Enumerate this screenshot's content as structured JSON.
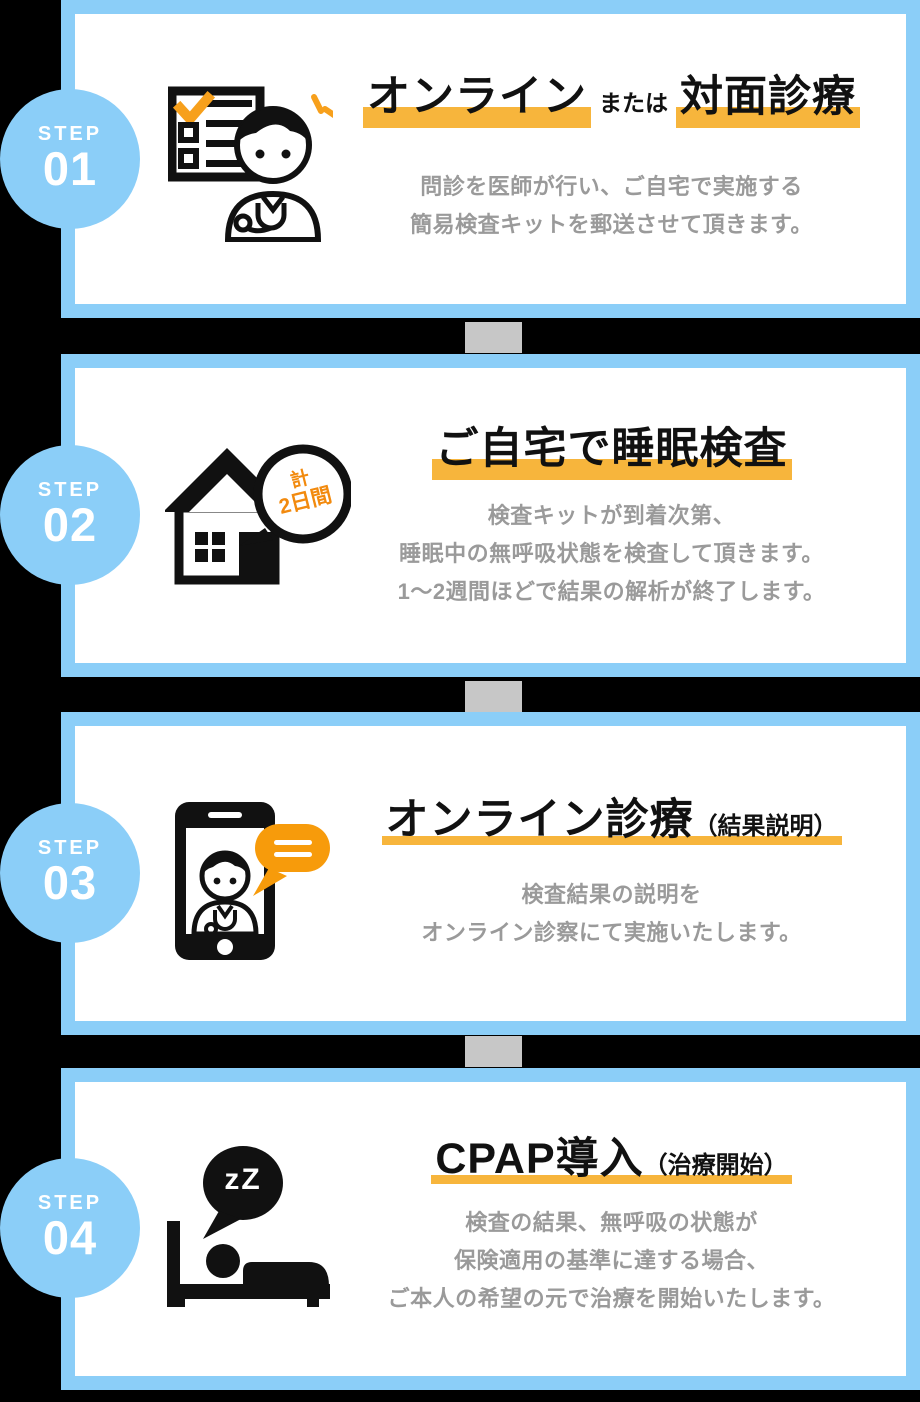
{
  "colors": {
    "background": "#000000",
    "card_border_blue": "#8BCEF8",
    "card_fill": "#FFFFFF",
    "step_circle_blue": "#8BCEF8",
    "step_text": "#FFFFFF",
    "connector_gray": "#C7C7C7",
    "title_text": "#111111",
    "body_text": "#9A9A9A",
    "highlight_orange": "#F7B53C",
    "icon_accent_orange": "#F79B0B",
    "badge_orange": "#F28A0E",
    "icon_black": "#111111"
  },
  "steps": [
    {
      "label": "STEP",
      "number": "01",
      "icon": "checklist-doctor-icon",
      "title_parts": [
        {
          "text": "オンライン",
          "highlight": true,
          "size": "large"
        },
        {
          "text": "または",
          "highlight": false,
          "size": "small"
        },
        {
          "text": "対面診療",
          "highlight": true,
          "size": "large"
        }
      ],
      "body_lines": [
        "問診を医師が行い、ご自宅で実施する",
        "簡易検査キットを郵送させて頂きます。"
      ]
    },
    {
      "label": "STEP",
      "number": "02",
      "icon": "house-sleep-test-icon",
      "badge": {
        "line1": "計",
        "line2": "2日間"
      },
      "title_parts": [
        {
          "text": "ご自宅で睡眠検査",
          "highlight": true,
          "size": "large"
        }
      ],
      "body_lines": [
        "検査キットが到着次第、",
        "睡眠中の無呼吸状態を検査して頂きます。",
        "1〜2週間ほどで結果の解析が終了します。"
      ]
    },
    {
      "label": "STEP",
      "number": "03",
      "icon": "smartphone-doctor-icon",
      "title_parts": [
        {
          "text": "オンライン診療",
          "highlight": true,
          "size": "large"
        },
        {
          "text": "（結果説明）",
          "highlight": true,
          "size": "small"
        }
      ],
      "body_lines": [
        "検査結果の説明を",
        "オンライン診察にて実施いたします。"
      ]
    },
    {
      "label": "STEP",
      "number": "04",
      "icon": "sleep-bed-icon",
      "badge_text": "zZ",
      "title_parts": [
        {
          "text": "CPAP導入",
          "highlight": true,
          "size": "large"
        },
        {
          "text": "（治療開始）",
          "highlight": true,
          "size": "small"
        }
      ],
      "body_lines": [
        "検査の結果、無呼吸の状態が",
        "保険適用の基準に達する場合、",
        "ご本人の希望の元で治療を開始いたします。"
      ]
    }
  ]
}
